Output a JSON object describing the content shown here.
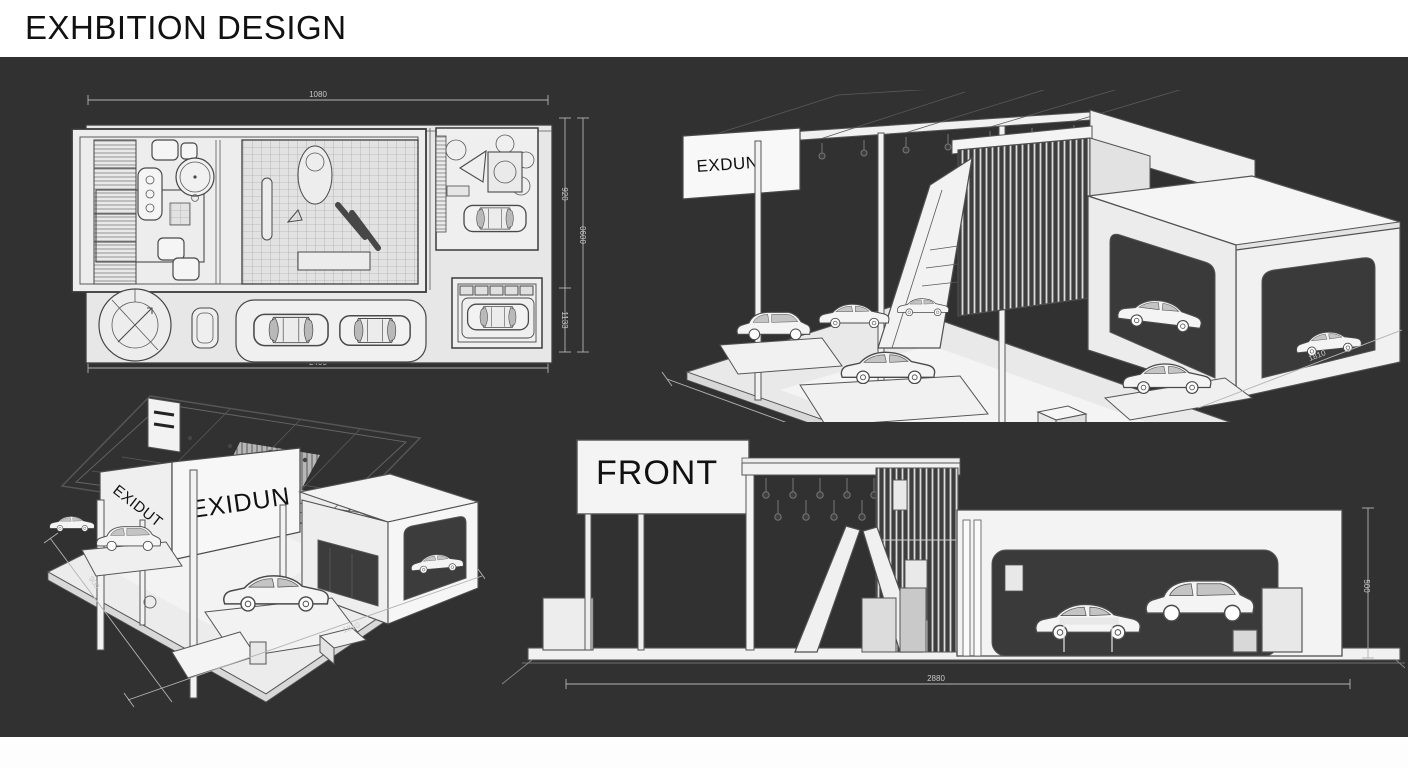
{
  "header": {
    "title": "EXHBITION DESIGN"
  },
  "colors": {
    "canvas_bg": "#313131",
    "paper": "#ffffff",
    "line": "#474747",
    "light_fill": "#ececec",
    "dim_line": "#b3b3b3",
    "dim_text": "#c8c8c8"
  },
  "floor_plan": {
    "name": "top view floor plan",
    "dims": {
      "top": "1080",
      "bottom": "2400",
      "right_inner_upper": "920",
      "right_inner_lower": "1133",
      "right_outer": "0600"
    }
  },
  "iso_top_right": {
    "name": "perspective view right",
    "sign": "EXDUN",
    "dims": {
      "front_left": "9157",
      "front_right": "1810"
    }
  },
  "iso_bottom_left": {
    "name": "perspective view left",
    "sign_side": "EXIDUT",
    "sign_front": "EXIDUN",
    "dims": {
      "left": "900",
      "front": "1810"
    }
  },
  "front_elevation": {
    "name": "front elevation",
    "sign": "FRONT",
    "dims": {
      "bottom": "2880",
      "right": "500"
    }
  }
}
